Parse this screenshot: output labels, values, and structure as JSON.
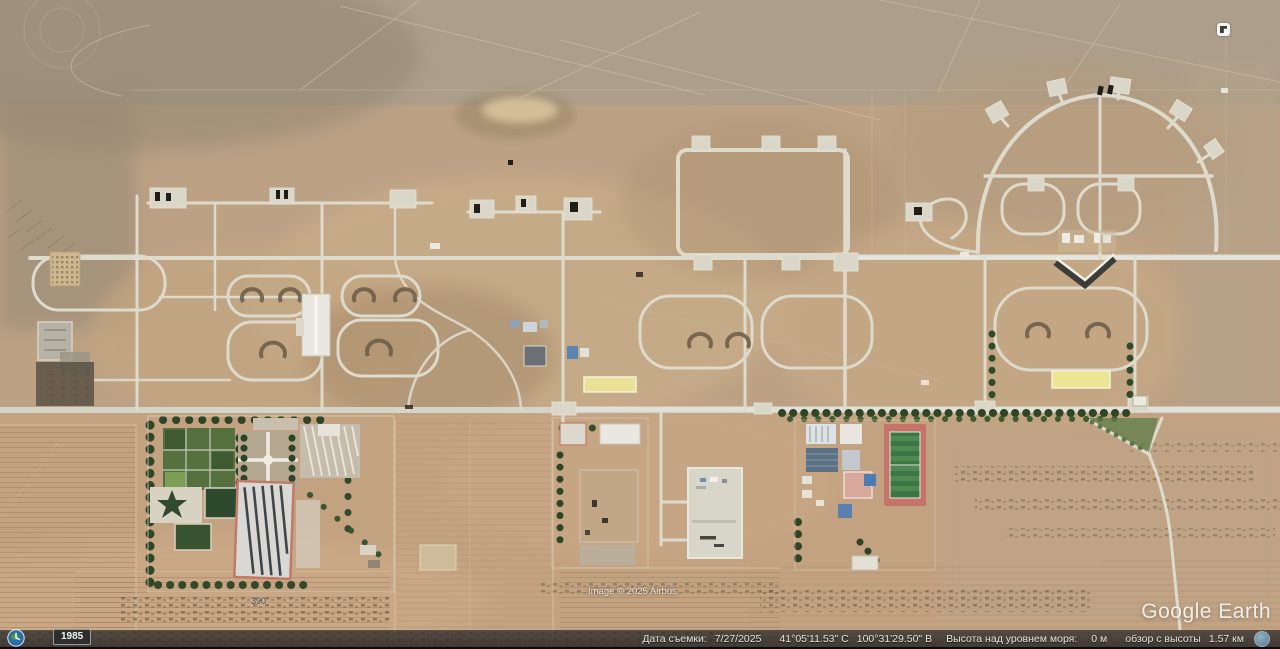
{
  "app": {
    "name": "Google Earth"
  },
  "map_overlay": {
    "watermark": "Google Earth",
    "copyright": "Image © 2025 Airbus",
    "terrain_label": "390",
    "historical_year": "1985"
  },
  "status_bar": {
    "capture_date_label": "Дата съемки:",
    "capture_date": "7/27/2025",
    "latitude": "41°05'11.53\" С",
    "longitude": "100°31'29.50\" В",
    "elevation_label": "Высота над уровнем моря:",
    "elevation_value": "0 м",
    "eye_alt_label": "обзор с высоты",
    "eye_alt_value": "1.57 км"
  },
  "icons": {
    "historical_imagery": "clock-globe-icon",
    "eye_altitude": "eye-icon",
    "navigation": "navigation-widget-icon"
  },
  "colors": {
    "desert_base": "#b9a083",
    "road": "#dedacc",
    "tree_green": "#32492a",
    "sports_field_green": "#3d7544",
    "track_pink": "#c5746a",
    "yellow_roof": "#e9e296",
    "status_bar_bg": "#2f2d2b"
  }
}
